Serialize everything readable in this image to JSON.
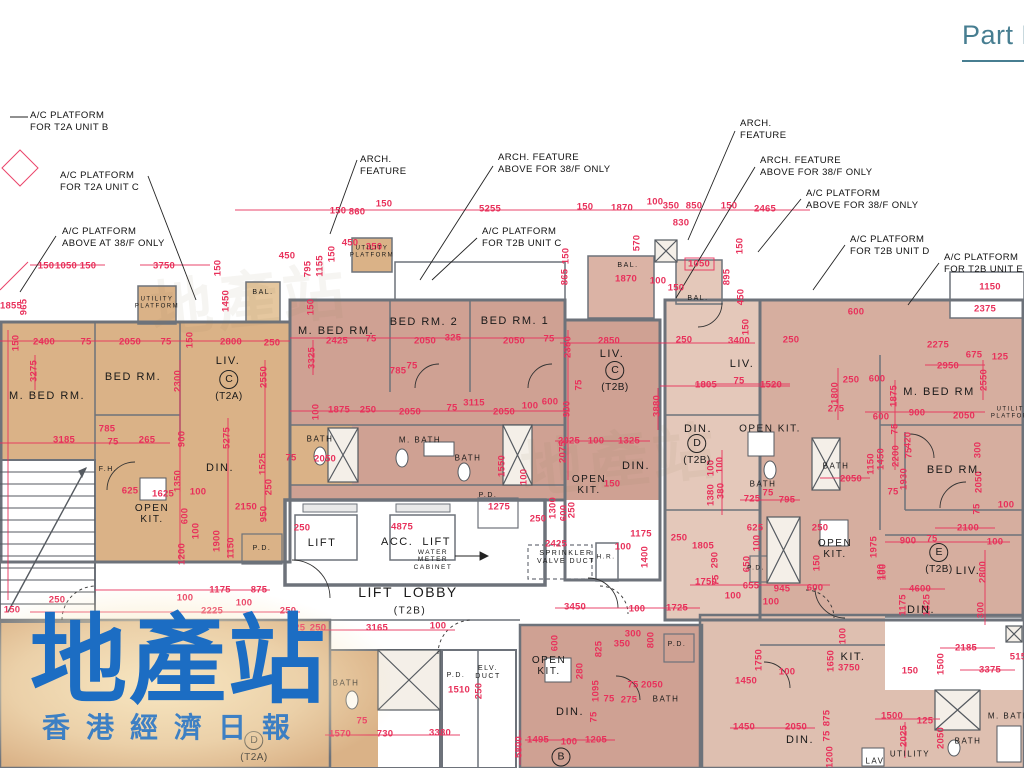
{
  "header": {
    "part_label": "Part F"
  },
  "watermark": {
    "title": "地產站",
    "subtitle": "香港經濟日報"
  },
  "callouts": [
    {
      "text": "A/C PLATFORM\nFOR T2A UNIT B",
      "x": 30,
      "y": 110
    },
    {
      "text": "A/C PLATFORM\nFOR T2A UNIT C",
      "x": 60,
      "y": 170
    },
    {
      "text": "A/C PLATFORM\nABOVE AT 38/F ONLY",
      "x": 62,
      "y": 226
    },
    {
      "text": "ARCH.\nFEATURE",
      "x": 360,
      "y": 154
    },
    {
      "text": "ARCH. FEATURE\nABOVE FOR 38/F ONLY",
      "x": 498,
      "y": 152
    },
    {
      "text": "A/C PLATFORM\nFOR T2B UNIT C",
      "x": 482,
      "y": 226
    },
    {
      "text": "ARCH.\nFEATURE",
      "x": 740,
      "y": 118
    },
    {
      "text": "ARCH. FEATURE\nABOVE FOR 38/F ONLY",
      "x": 760,
      "y": 155
    },
    {
      "text": "A/C PLATFORM\nABOVE FOR 38/F ONLY",
      "x": 806,
      "y": 188
    },
    {
      "text": "A/C PLATFORM\nFOR T2B UNIT D",
      "x": 850,
      "y": 234
    },
    {
      "text": "A/C PLATFORM\nFOR T2B UNIT E",
      "x": 944,
      "y": 252
    }
  ],
  "room_labels": [
    {
      "t": "UTILITY\nPLATFORM",
      "x": 157,
      "y": 303,
      "s": 6
    },
    {
      "t": "UTILITY\nPLATFORM",
      "x": 372,
      "y": 252,
      "s": 6
    },
    {
      "t": "UTILITY\nPLATFORM",
      "x": 1013,
      "y": 413,
      "s": 6
    },
    {
      "t": "BAL.",
      "x": 263,
      "y": 293,
      "s": 7
    },
    {
      "t": "BAL.",
      "x": 628,
      "y": 266,
      "s": 7
    },
    {
      "t": "BAL.",
      "x": 698,
      "y": 299,
      "s": 7
    },
    {
      "t": "M. BED RM.",
      "x": 47,
      "y": 396,
      "s": 11
    },
    {
      "t": "BED RM.",
      "x": 133,
      "y": 377,
      "s": 11
    },
    {
      "t": "LIV.",
      "x": 228,
      "y": 361,
      "s": 11
    },
    {
      "t": "DIN.",
      "x": 220,
      "y": 468,
      "s": 11
    },
    {
      "t": "OPEN\nKIT.",
      "x": 152,
      "y": 514,
      "s": 10
    },
    {
      "t": "F.H.",
      "x": 108,
      "y": 470,
      "s": 7
    },
    {
      "t": "P.D.",
      "x": 262,
      "y": 549,
      "s": 7
    },
    {
      "t": "M. BED RM.",
      "x": 336,
      "y": 331,
      "s": 11
    },
    {
      "t": "BED RM. 2",
      "x": 424,
      "y": 322,
      "s": 11
    },
    {
      "t": "BED RM. 1",
      "x": 515,
      "y": 321,
      "s": 11
    },
    {
      "t": "BATH",
      "x": 320,
      "y": 440,
      "s": 8
    },
    {
      "t": "M. BATH",
      "x": 420,
      "y": 441,
      "s": 8
    },
    {
      "t": "BATH",
      "x": 468,
      "y": 459,
      "s": 8
    },
    {
      "t": "LIV.",
      "x": 612,
      "y": 354,
      "s": 11
    },
    {
      "t": "DIN.",
      "x": 636,
      "y": 466,
      "s": 11
    },
    {
      "t": "OPEN\nKIT.",
      "x": 589,
      "y": 485,
      "s": 10
    },
    {
      "t": "LIV.",
      "x": 742,
      "y": 364,
      "s": 11
    },
    {
      "t": "DIN.",
      "x": 698,
      "y": 429,
      "s": 11
    },
    {
      "t": "OPEN KIT.",
      "x": 770,
      "y": 429,
      "s": 10
    },
    {
      "t": "BATH",
      "x": 763,
      "y": 485,
      "s": 8
    },
    {
      "t": "BATH",
      "x": 836,
      "y": 467,
      "s": 8
    },
    {
      "t": "OPEN\nKIT.",
      "x": 835,
      "y": 549,
      "s": 10
    },
    {
      "t": "M. BED RM",
      "x": 939,
      "y": 392,
      "s": 11
    },
    {
      "t": "BED RM.",
      "x": 955,
      "y": 470,
      "s": 11
    },
    {
      "t": "LIV.",
      "x": 968,
      "y": 571,
      "s": 11
    },
    {
      "t": "DIN.",
      "x": 921,
      "y": 610,
      "s": 11
    },
    {
      "t": "LIFT",
      "x": 322,
      "y": 543,
      "s": 11
    },
    {
      "t": "ACC.  LIFT",
      "x": 416,
      "y": 542,
      "s": 11
    },
    {
      "t": "WATER\nMETER\nCABINET",
      "x": 433,
      "y": 560,
      "s": 6.5
    },
    {
      "t": "LIFT  LOBBY",
      "x": 408,
      "y": 593,
      "s": 14
    },
    {
      "t": "(T2B)",
      "x": 410,
      "y": 611,
      "s": 10
    },
    {
      "t": "SPRINKLER\nVALVE DUCT",
      "x": 566,
      "y": 558,
      "s": 7
    },
    {
      "t": "H.R.",
      "x": 606,
      "y": 557,
      "s": 6.5
    },
    {
      "t": "P.D.",
      "x": 488,
      "y": 496,
      "s": 7
    },
    {
      "t": "P.D.",
      "x": 756,
      "y": 568,
      "s": 6.5
    },
    {
      "t": "BATH",
      "x": 346,
      "y": 684,
      "s": 8
    },
    {
      "t": "P.D.",
      "x": 456,
      "y": 676,
      "s": 7
    },
    {
      "t": "ELV.\nDUCT",
      "x": 488,
      "y": 673,
      "s": 7
    },
    {
      "t": "OPEN\nKIT.",
      "x": 549,
      "y": 666,
      "s": 10
    },
    {
      "t": "DIN.",
      "x": 570,
      "y": 712,
      "s": 11
    },
    {
      "t": "P.D.",
      "x": 677,
      "y": 645,
      "s": 7
    },
    {
      "t": "BATH",
      "x": 666,
      "y": 700,
      "s": 8
    },
    {
      "t": "KIT.",
      "x": 853,
      "y": 657,
      "s": 11
    },
    {
      "t": "DIN.",
      "x": 800,
      "y": 740,
      "s": 11
    },
    {
      "t": "LAV",
      "x": 875,
      "y": 762,
      "s": 8
    },
    {
      "t": "UTILITY",
      "x": 910,
      "y": 755,
      "s": 8
    },
    {
      "t": "BATH",
      "x": 968,
      "y": 742,
      "s": 8
    },
    {
      "t": "M. BATH",
      "x": 1009,
      "y": 717,
      "s": 8
    }
  ],
  "unit_marks": [
    {
      "letter": "C",
      "unit": "(T2A)",
      "x": 229,
      "y": 386
    },
    {
      "letter": "C",
      "unit": "(T2B)",
      "x": 615,
      "y": 377
    },
    {
      "letter": "D",
      "unit": "(T2B)",
      "x": 697,
      "y": 450
    },
    {
      "letter": "E",
      "unit": "(T2B)",
      "x": 939,
      "y": 559
    },
    {
      "letter": "B",
      "unit": "",
      "x": 561,
      "y": 757
    },
    {
      "letter": "D",
      "unit": "(T2A)",
      "x": 254,
      "y": 747
    }
  ],
  "dims": [
    [
      "150",
      46,
      266
    ],
    [
      "1050",
      66,
      266
    ],
    [
      "150",
      88,
      266
    ],
    [
      "3750",
      164,
      266
    ],
    [
      "150",
      218,
      268,
      1
    ],
    [
      "450",
      287,
      256
    ],
    [
      "1450",
      226,
      301,
      1
    ],
    [
      "1855",
      11,
      306
    ],
    [
      "965",
      24,
      307,
      1
    ],
    [
      "150",
      16,
      343,
      1
    ],
    [
      "795",
      308,
      269,
      1
    ],
    [
      "1155",
      320,
      266,
      1
    ],
    [
      "150",
      332,
      254,
      1
    ],
    [
      "450",
      350,
      243
    ],
    [
      "350",
      374,
      247
    ],
    [
      "150",
      338,
      211
    ],
    [
      "860",
      357,
      212
    ],
    [
      "150",
      384,
      204
    ],
    [
      "5255",
      490,
      209
    ],
    [
      "150",
      585,
      207
    ],
    [
      "1870",
      622,
      208
    ],
    [
      "100",
      655,
      202
    ],
    [
      "350",
      671,
      206
    ],
    [
      "850",
      694,
      206
    ],
    [
      "830",
      681,
      223
    ],
    [
      "150",
      729,
      206
    ],
    [
      "2465",
      765,
      209
    ],
    [
      "570",
      637,
      243,
      1
    ],
    [
      "865",
      565,
      277,
      1
    ],
    [
      "150",
      566,
      256,
      1
    ],
    [
      "1870",
      626,
      279
    ],
    [
      "100",
      658,
      281
    ],
    [
      "1050",
      699,
      264
    ],
    [
      "150",
      676,
      288
    ],
    [
      "895",
      727,
      277,
      1
    ],
    [
      "450",
      741,
      297,
      1
    ],
    [
      "150",
      740,
      246,
      1
    ],
    [
      "1150",
      990,
      287
    ],
    [
      "600",
      856,
      312
    ],
    [
      "2375",
      985,
      309
    ],
    [
      "2275",
      938,
      345
    ],
    [
      "675",
      974,
      355
    ],
    [
      "125",
      1000,
      357
    ],
    [
      "2950",
      948,
      366
    ],
    [
      "2550",
      984,
      380,
      1
    ],
    [
      "250",
      851,
      380
    ],
    [
      "600",
      877,
      379
    ],
    [
      "1800",
      835,
      393,
      1
    ],
    [
      "275",
      836,
      409
    ],
    [
      "1875",
      894,
      396,
      1
    ],
    [
      "600",
      881,
      417
    ],
    [
      "900",
      917,
      413
    ],
    [
      "2050",
      964,
      416
    ],
    [
      "75",
      895,
      429,
      1
    ],
    [
      "420",
      908,
      440,
      1
    ],
    [
      "2200",
      896,
      456,
      1
    ],
    [
      "75",
      909,
      453,
      1
    ],
    [
      "1930",
      904,
      479,
      1
    ],
    [
      "1450",
      881,
      459,
      1
    ],
    [
      "300",
      978,
      450,
      1
    ],
    [
      "2050",
      979,
      482,
      1
    ],
    [
      "100",
      1006,
      505
    ],
    [
      "75",
      977,
      509,
      1
    ],
    [
      "2400",
      44,
      342
    ],
    [
      "75",
      86,
      342
    ],
    [
      "2050",
      130,
      342
    ],
    [
      "75",
      166,
      342
    ],
    [
      "150",
      190,
      340,
      1
    ],
    [
      "2800",
      231,
      342
    ],
    [
      "250",
      272,
      343
    ],
    [
      "3275",
      34,
      371,
      1
    ],
    [
      "2300",
      178,
      381,
      1
    ],
    [
      "2550",
      264,
      377,
      1
    ],
    [
      "785",
      107,
      429
    ],
    [
      "75",
      113,
      442
    ],
    [
      "3185",
      64,
      440
    ],
    [
      "265",
      147,
      440
    ],
    [
      "900",
      182,
      439,
      1
    ],
    [
      "5275",
      227,
      438,
      1
    ],
    [
      "1525",
      263,
      464,
      1
    ],
    [
      "1350",
      178,
      481,
      1
    ],
    [
      "1625",
      163,
      494
    ],
    [
      "100",
      198,
      492
    ],
    [
      "2150",
      246,
      507
    ],
    [
      "250",
      269,
      487,
      1
    ],
    [
      "950",
      264,
      514,
      1
    ],
    [
      "600",
      185,
      516,
      1
    ],
    [
      "625",
      130,
      491
    ],
    [
      "1900",
      217,
      541,
      1
    ],
    [
      "1200",
      182,
      554,
      1
    ],
    [
      "1150",
      231,
      548,
      1
    ],
    [
      "100",
      196,
      531,
      1
    ],
    [
      "1175",
      220,
      590
    ],
    [
      "875",
      259,
      590
    ],
    [
      "100",
      185,
      598
    ],
    [
      "100",
      244,
      603
    ],
    [
      "2225",
      212,
      611
    ],
    [
      "250",
      288,
      611
    ],
    [
      "525",
      297,
      628
    ],
    [
      "250",
      318,
      628
    ],
    [
      "250",
      57,
      600
    ],
    [
      "150",
      12,
      610
    ],
    [
      "150",
      311,
      307,
      1
    ],
    [
      "2425",
      337,
      341
    ],
    [
      "75",
      371,
      339
    ],
    [
      "2050",
      425,
      341
    ],
    [
      "325",
      453,
      338
    ],
    [
      "2050",
      514,
      341
    ],
    [
      "75",
      549,
      339
    ],
    [
      "3325",
      312,
      358,
      1
    ],
    [
      "2350",
      568,
      347,
      1
    ],
    [
      "785",
      398,
      371
    ],
    [
      "75",
      412,
      366
    ],
    [
      "1875",
      339,
      410
    ],
    [
      "250",
      368,
      410
    ],
    [
      "2050",
      410,
      412
    ],
    [
      "75",
      452,
      408
    ],
    [
      "3115",
      474,
      403
    ],
    [
      "2050",
      504,
      412
    ],
    [
      "100",
      530,
      406
    ],
    [
      "600",
      550,
      402
    ],
    [
      "900",
      567,
      409,
      1
    ],
    [
      "100",
      316,
      412,
      1
    ],
    [
      "75",
      291,
      458
    ],
    [
      "2050",
      325,
      459
    ],
    [
      "1550",
      502,
      466,
      1
    ],
    [
      "100",
      524,
      477,
      1
    ],
    [
      "2075",
      563,
      452,
      1
    ],
    [
      "250",
      302,
      528
    ],
    [
      "4875",
      402,
      527
    ],
    [
      "1275",
      499,
      507
    ],
    [
      "2425",
      556,
      544
    ],
    [
      "250",
      538,
      519
    ],
    [
      "1300",
      553,
      508,
      1
    ],
    [
      "600",
      564,
      513,
      1
    ],
    [
      "250",
      572,
      510,
      1
    ],
    [
      "1175",
      641,
      534
    ],
    [
      "100",
      623,
      547
    ],
    [
      "250",
      679,
      538
    ],
    [
      "1805",
      703,
      546
    ],
    [
      "1400",
      645,
      557,
      1
    ],
    [
      "3165",
      377,
      628
    ],
    [
      "100",
      438,
      626
    ],
    [
      "3450",
      575,
      607
    ],
    [
      "100",
      637,
      609
    ],
    [
      "1725",
      677,
      608
    ],
    [
      "2850",
      609,
      341
    ],
    [
      "250",
      684,
      340
    ],
    [
      "3400",
      739,
      341
    ],
    [
      "150",
      746,
      327,
      1
    ],
    [
      "250",
      791,
      340
    ],
    [
      "75",
      579,
      385,
      1
    ],
    [
      "1805",
      706,
      385
    ],
    [
      "75",
      739,
      381
    ],
    [
      "1520",
      771,
      385
    ],
    [
      "3880",
      657,
      406,
      1
    ],
    [
      "2025",
      569,
      441
    ],
    [
      "100",
      596,
      441
    ],
    [
      "1325",
      629,
      441
    ],
    [
      "100",
      720,
      465,
      1
    ],
    [
      "380",
      721,
      491,
      1
    ],
    [
      "150",
      612,
      484
    ],
    [
      "725",
      752,
      499
    ],
    [
      "75",
      768,
      493
    ],
    [
      "795",
      787,
      500
    ],
    [
      "1380",
      711,
      495,
      1
    ],
    [
      "100",
      711,
      468,
      1
    ],
    [
      "2050",
      851,
      479
    ],
    [
      "1150",
      871,
      464,
      1
    ],
    [
      "75",
      893,
      492
    ],
    [
      "625",
      755,
      528
    ],
    [
      "100",
      757,
      543,
      1
    ],
    [
      "650",
      747,
      564,
      1
    ],
    [
      "290",
      715,
      560,
      1
    ],
    [
      "75",
      716,
      580,
      1
    ],
    [
      "250",
      820,
      528
    ],
    [
      "150",
      817,
      563,
      1
    ],
    [
      "1975",
      874,
      547,
      1
    ],
    [
      "100",
      881,
      572,
      1
    ],
    [
      "1750",
      706,
      582
    ],
    [
      "945",
      782,
      589
    ],
    [
      "600",
      815,
      588
    ],
    [
      "655",
      751,
      586
    ],
    [
      "100",
      733,
      596
    ],
    [
      "100",
      771,
      602
    ],
    [
      "1175",
      903,
      605,
      1
    ],
    [
      "1325",
      927,
      605,
      1
    ],
    [
      "2100",
      968,
      528
    ],
    [
      "900",
      908,
      541
    ],
    [
      "75",
      932,
      539
    ],
    [
      "100",
      995,
      542
    ],
    [
      "100",
      883,
      572,
      1
    ],
    [
      "2800",
      983,
      572,
      1
    ],
    [
      "4600",
      920,
      589
    ],
    [
      "300",
      981,
      610,
      1
    ],
    [
      "2185",
      966,
      648
    ],
    [
      "1500",
      941,
      664,
      1
    ],
    [
      "3375",
      990,
      670
    ],
    [
      "515",
      1018,
      657
    ],
    [
      "150",
      910,
      671
    ],
    [
      "1650",
      831,
      661,
      1
    ],
    [
      "3750",
      849,
      668
    ],
    [
      "100",
      843,
      636,
      1
    ],
    [
      "1750",
      759,
      660,
      1
    ],
    [
      "1450",
      746,
      681
    ],
    [
      "100",
      787,
      672
    ],
    [
      "1450",
      744,
      727
    ],
    [
      "2050",
      796,
      727
    ],
    [
      "875",
      827,
      718,
      1
    ],
    [
      "75",
      827,
      736,
      1
    ],
    [
      "1200",
      830,
      757,
      1
    ],
    [
      "1500",
      892,
      716
    ],
    [
      "125",
      925,
      721
    ],
    [
      "2025",
      904,
      736,
      1
    ],
    [
      "2050",
      941,
      738,
      1
    ],
    [
      "1510",
      459,
      690
    ],
    [
      "250",
      479,
      691,
      1
    ],
    [
      "1570",
      340,
      734
    ],
    [
      "75",
      362,
      721
    ],
    [
      "730",
      385,
      734
    ],
    [
      "3380",
      440,
      733
    ],
    [
      "5800",
      519,
      747,
      1
    ],
    [
      "1495",
      538,
      740
    ],
    [
      "100",
      569,
      742
    ],
    [
      "1205",
      596,
      740
    ],
    [
      "600",
      555,
      643,
      1
    ],
    [
      "825",
      599,
      649,
      1
    ],
    [
      "280",
      580,
      671,
      1
    ],
    [
      "1095",
      596,
      691,
      1
    ],
    [
      "75",
      594,
      717,
      1
    ],
    [
      "350",
      622,
      644
    ],
    [
      "300",
      633,
      634
    ],
    [
      "800",
      651,
      640,
      1
    ],
    [
      "75",
      633,
      685
    ],
    [
      "2050",
      652,
      685
    ],
    [
      "75",
      609,
      699
    ],
    [
      "275",
      629,
      700
    ]
  ]
}
